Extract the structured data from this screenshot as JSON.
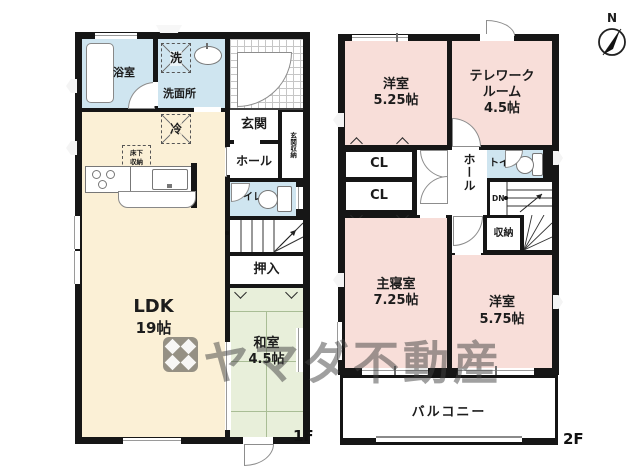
{
  "compass": {
    "north": "N"
  },
  "watermark": {
    "brand": "ヤマダ不動産"
  },
  "floor1": {
    "name": "1F",
    "bath": "浴室",
    "washer": "洗",
    "washroom": "洗面所",
    "fridge": "冷",
    "underfloor_1": "床下",
    "underfloor_2": "収納",
    "entrance": "玄関",
    "entrance_storage": "玄関収納",
    "hall": "ホール",
    "toilet": "トイレ",
    "up": "UP",
    "closet": "押入",
    "ldk": "LDK",
    "ldk_size": "19帖",
    "tatami": "和室",
    "tatami_size": "4.5帖"
  },
  "floor2": {
    "name": "2F",
    "room1": "洋室",
    "room1_size": "5.25帖",
    "telework_1": "テレワーク",
    "telework_2": "ルーム",
    "telework_size": "4.5帖",
    "cl1": "CL",
    "cl2": "CL",
    "hall": "ホール",
    "toilet": "トイレ",
    "dn": "DN",
    "storage": "収納",
    "master": "主寝室",
    "master_size": "7.25帖",
    "room2": "洋室",
    "room2_size": "5.75帖",
    "balcony": "バルコニー"
  },
  "colors": {
    "wall": "#161616",
    "room_cream": "#fbf0d6",
    "room_pink": "#f8ded9",
    "room_green": "#e8efda",
    "room_blue": "#cfe5f0",
    "tatami_line": "#a9bd95"
  }
}
